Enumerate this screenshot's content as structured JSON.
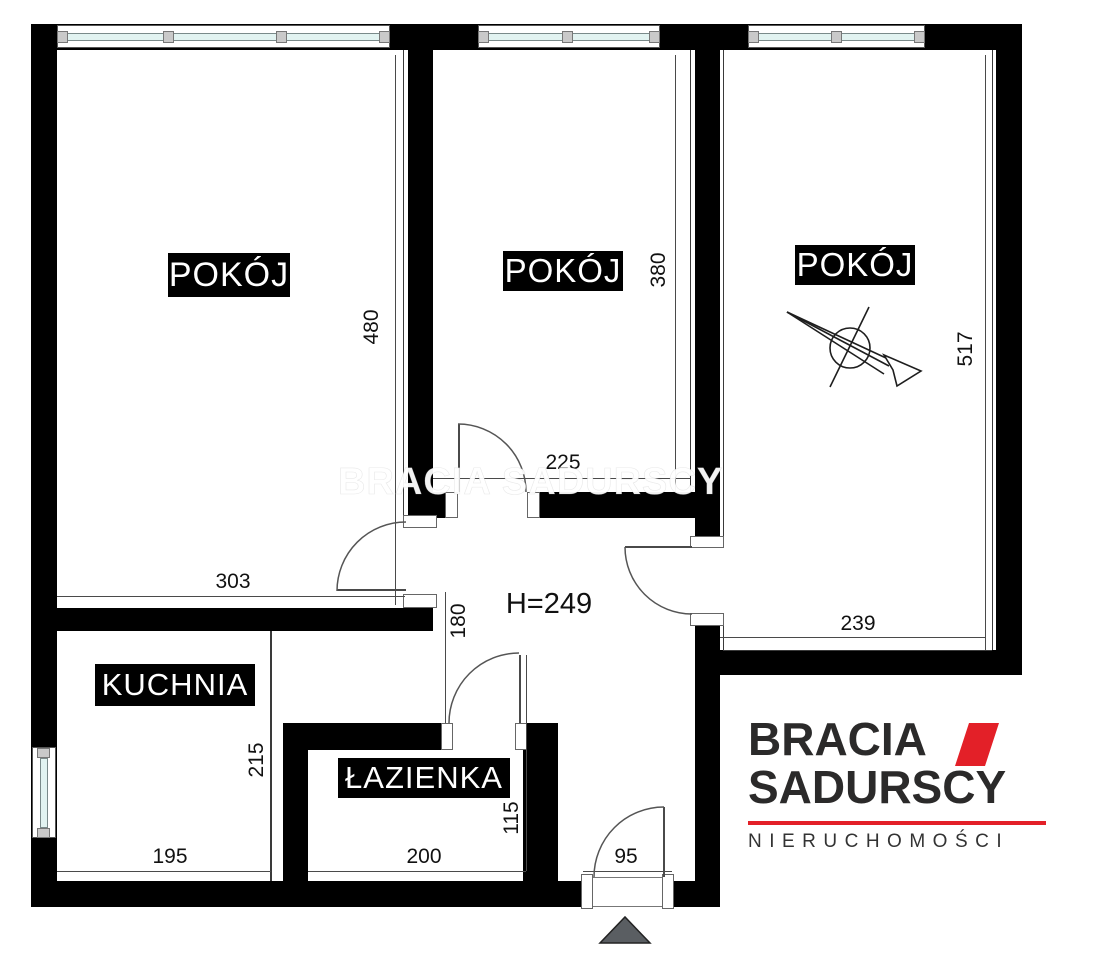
{
  "rooms": {
    "pokoj1": "POKÓJ",
    "pokoj2": "POKÓJ",
    "pokoj3": "POKÓJ",
    "kuchnia": "KUCHNIA",
    "lazienka": "ŁAZIENKA"
  },
  "dimensions": {
    "d480": "480",
    "d380": "380",
    "d517": "517",
    "d303": "303",
    "d225": "225",
    "d239": "239",
    "d180": "180",
    "d215": "215",
    "d115": "115",
    "d195": "195",
    "d200": "200",
    "d95": "95",
    "ceiling_height": "H=249"
  },
  "watermark": {
    "text": "BRACIA SADURSCY"
  },
  "logo": {
    "brand_line1": "BRACIA",
    "brand_line2": "SADURSCY",
    "tagline": "NIERUCHOMOŚCI",
    "accent_color": "#e32028"
  },
  "colors": {
    "wall": "#000000",
    "window_glass": "#e2f3f1",
    "entrance_arrow": "#5a5e62"
  }
}
